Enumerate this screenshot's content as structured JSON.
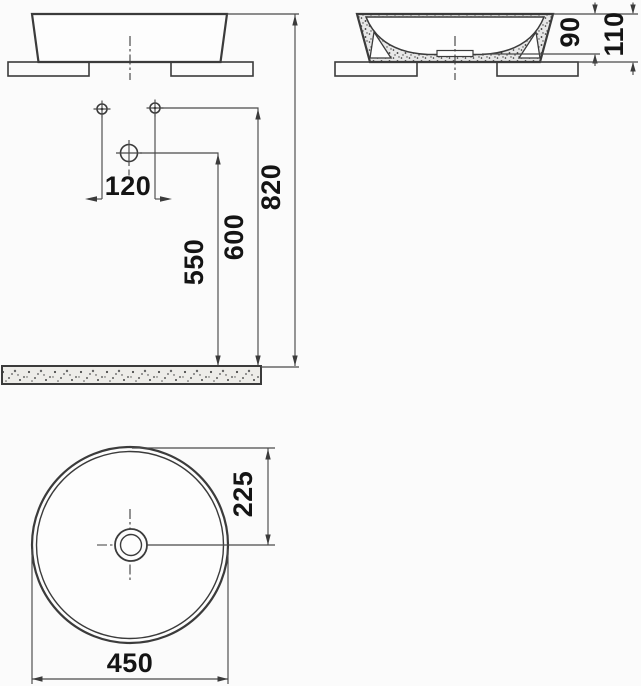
{
  "drawing_type": "washbasin technical dimension drawing",
  "colors": {
    "background": "#fbfbfb",
    "line": "#3b3b3b",
    "label_text": "#141414",
    "floor_fill": "#edece8",
    "ceramic_wall_fill": "#e7e7e7"
  },
  "dims": {
    "hole_spacing": "120",
    "drain_height": "550",
    "supply_height": "600",
    "rim_height": "820",
    "bowl_depth": "90",
    "basin_height": "110",
    "center_offset": "225",
    "basin_diameter": "450"
  }
}
